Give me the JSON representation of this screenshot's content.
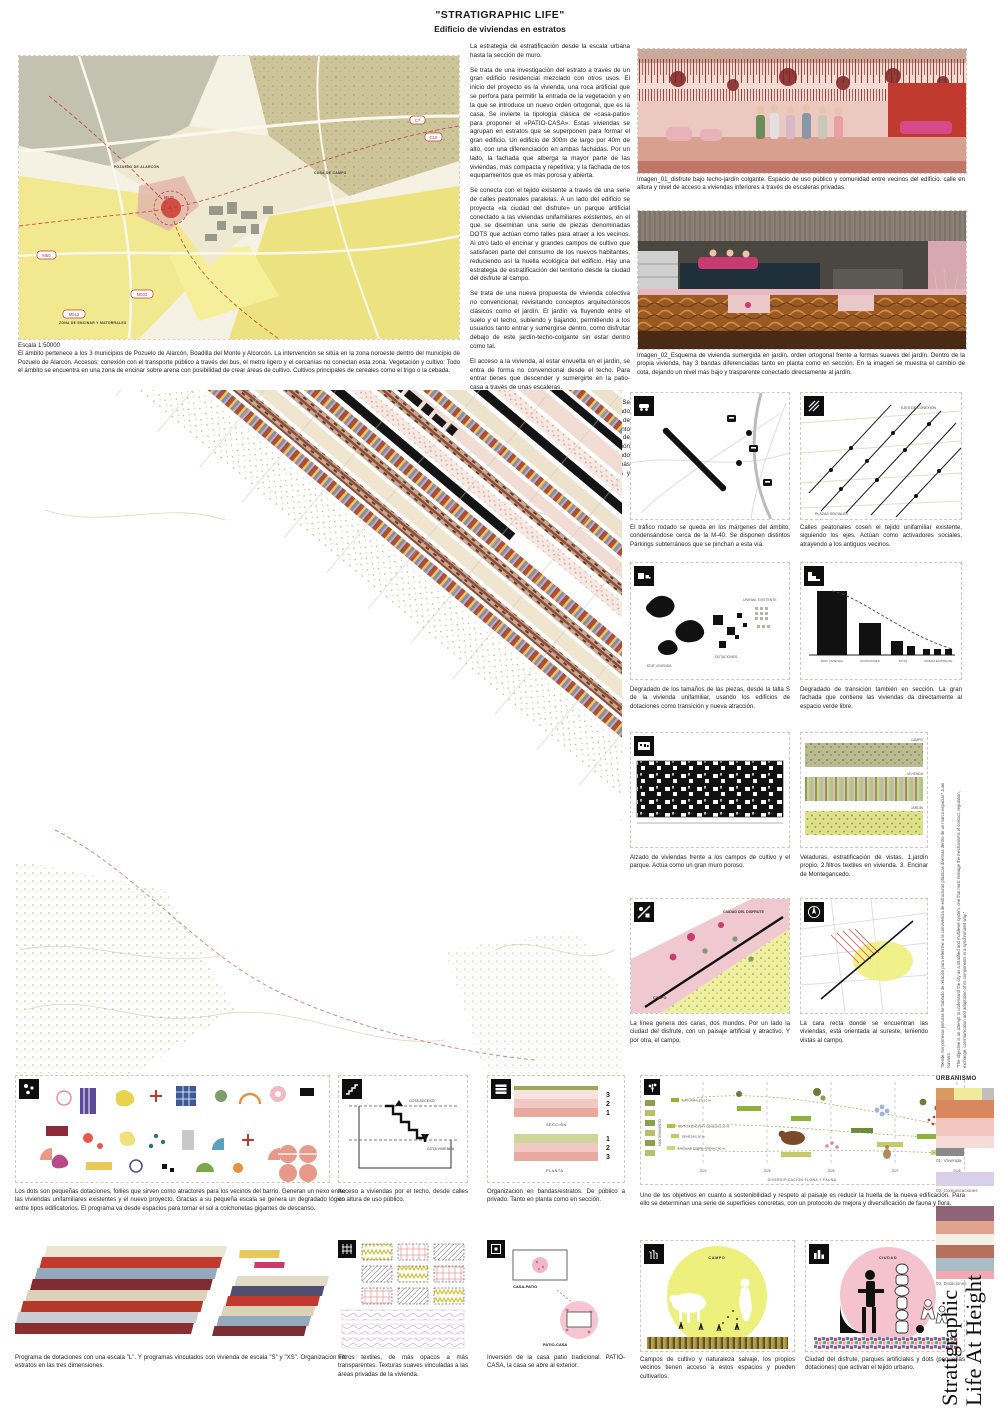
{
  "header": {
    "title": "\"STRATIGRAPHIC LIFE\"",
    "subtitle": "Edificio de viviendas en estratos"
  },
  "intro": {
    "paragraphs": [
      "La estrategia de estratificación desde la escala urbana hasta la sección de muro.",
      "Se trata de una investigación del estrato a través de un gran edificio residencial mezclado con otros usos. El inicio del proyecto es la vivienda, una roca artificial que se perfora para permitir la entrada de la vegetación y en la que se introduce un nuevo orden ortogonal, que es la casa. Se invierte la tipología clásica de «casa-patio» para proponer el «PATIO-CASA». Estas viviendas se agrupan en estratos que se superponen para formar el gran edificio. Un edificio de 300m de largo por 40m de alto, con una diferenciación en ambas fachadas. Por un lado, la fachada que alberga la mayor parte de las viviendas, más compacta y repetitiva; y la fachada de los equipamientos que es más porosa y abierta.",
      "Se conecta con el tejido existente a través de una serie de calles peatonales paralelas. A un lado del edificio se proyecta «la ciudad del disfrute» un parque artificial conectado a las viviendas unifamiliares existentes, en el que se diseminan una serie de piezas denominadas DOTS que actúan como talles para atraer a los vecinos. Al otro lado el encinar y grandes campos de cultivo que satisfacen parte del consumo de los nuevos habitantes, reduciendo así la huella ecológica del edificio. Hay una estrategia de estratificación del territorio desde la ciudad del disfrute al campo.",
      "Se trata de una nueva propuesta de vivienda colectiva no convencional, revisitando conceptos arquitectónicos clásicos como el jardín. El jardín va fluyendo entre el suelo y el techo, subiendo y bajando, permitiendo a los usuarios tanto entrar y sumergirse dentro, como disfrutar debajo de este jardín-techo-colgante sin estar dentro como tal.",
      "El acceso a la vivienda, al estar envuelta en el jardín, se entra de forma no convencional desde el techo. Para entrar tienes que descender y sumergirte en la patio-casa a través de unas escaleras.",
      "La vivienda se organiza en tres bandas, 3 estratos. Se disponen creando una degradación entre la más privado como es el dormitorio y el aseo, hasta una zona de disfrute y reunión más pública. Como elemento diferenciador entre capa y capa aparecen una serie de veladuras o filtros creando de nuevo una estratificación esta vez de vistas dentro de la propia vivienda. Siendo más opacos y de textura suave en la banda de más privacidad, para pasar a texturas más duras, frías y transparentes en la zona pública."
    ]
  },
  "site_map": {
    "scale": "Escala 1:50000",
    "caption": "El ámbito pertenece a los 3 municipios de Pozuelo de Alarcón, Boadilla del Monte y Alcorcón. La intervención se sitúa en la zona noroeste dentro del municipio de Pozuelo de Alarcón. Accesos: conexión con el transporte público a través del bus, el metro ligero y el cercanías no conectan esta zona. Vegetación y cultivo: Todo el ámbito se encuentra en una zona de encinar sobre arena con posibilidad de crear áreas de cultivo. Cultivos principales de cereales como el trigo o la cebada.",
    "labels": {
      "c7": "C7",
      "c10": "C10",
      "bus": "BUS",
      "m50": "M50",
      "m503": "M503",
      "m513": "M513",
      "casa_de_campo": "CASA DE CAMPO",
      "pozuelo": "POZUELO DE ALARCÓN",
      "encinar": "ZONA DE ENCINAR Y MATORRALES"
    }
  },
  "renders": {
    "img1_caption": "Imagen_01_disfrute bajo techo-jardín colgante. Espacio de uso público y comunidad entre vecinos del edificio. calle en altura y nivel de acceso a viviendas inferiores a través de escaleras privadas.",
    "img2_caption": "Imagen_02_Esquema de vivienda sumergida en jardín. orden ortogonal frente a formas suaves del jardín. Dentro de la propia vivienda, hay 3 bandas diferenciadas tanto en planta como en sección. En la imagen se muestra el cambio de cota, dejando un nivel más bajo y trasparente conectado directamente al jardín."
  },
  "grid": {
    "cards": [
      {
        "caption": "El tráfico rodado se queda en los márgenes del ámbito, condensándose cerca de la M-40. Se disponen distintos Parkings subterráneos que se pinchan a esta vía."
      },
      {
        "caption": "Calles peatonales cosen el tejido unifamiliar existente, siguiendo los ejes. Actúan como activadores sociales, atrayendo a los antiguos vecinos.",
        "labels": {
          "ejes": "EJES DE CONEXIÓN",
          "plazas": "PLAZAS SOCIALES"
        }
      },
      {
        "caption": "Degradado de los tamaños de las piezas, desde la talla S de la vivienda unifamiliar, usando los edificios de dotaciones como transición y nueva atracción.",
        "labels": {
          "unifam": "UNIFAM. EXISTENTE",
          "dotaciones": "DOTACIONES",
          "vivienda": "EDIF VIVIENDA"
        }
      },
      {
        "caption": "Degradado de transición también en sección. La gran fachada que contiene las viviendas da directamente al espacio verde libre.",
        "labels": {
          "vivienda": "EDIF VIVIENDA",
          "dotaciones": "DOTACIONES",
          "dots": "DOTS",
          "unifam": "UNIFAM EXISTENTE"
        }
      },
      {
        "caption": "Alzado de viviendas frente a los campos de cultivo y el parque. Actúa como un gran muro poroso."
      },
      {
        "caption": "Veladuras, estratificación de vistas. 1.jardín propio. 2.filtros textiles en vivienda. 3. Encinar de Montegancedo.",
        "labels": {
          "campo": "CAMPO",
          "vivienda": "VIVIENDA",
          "jardin": "JARDÍN"
        }
      },
      {
        "caption": "La línea genera dos caras, dos mundos. Por un lado la ciudad del disfrute, con un paisaje artificial y atractivo. Y por otra, el campo.",
        "labels": {
          "ciudad": "CIUDAD DEL DISFRUTE",
          "campo": "CAMPO"
        }
      },
      {
        "caption": "La cara recta donde se encuentran las viviendas, está orientada al sureste, teniendo vistas al campo."
      }
    ]
  },
  "bottom": {
    "dots_caption": "Los dots son pequeñas dotaciones, follies que sirven como atractores para los vecinos del barrio. Generan un nexo entre las viviendas unifamiliares existentes y el nuevo proyecto. Gracias a su pequeña escala se genera un degradado lógico entre tipos edificatorios. El programa va desde espacios para tomar el sol a colchonetas gigantes de descanso.",
    "acceso_caption": "Acceso a viviendas por el techo, desde calles en altura de uso público.",
    "acceso_labels": {
      "upper": "COTA ACCESO",
      "lower": "COTA VIVIENDA"
    },
    "bandas_caption": "Organización en bandas/estratos. De público a privado. Tanto en planta como en sección.",
    "bandas_labels": {
      "seccion": "SECCIÓN",
      "planta": "PLANTA",
      "sec_numbers": [
        "3",
        "2",
        "1"
      ],
      "plan_numbers": [
        "1",
        "2",
        "3"
      ]
    },
    "huella_caption": "Uno de los objetivos en cuanto a sostenibilidad y respeto al paisaje es reducir la huella de la nueva edificación. Para ello se determinan una serie de superficies concretas, con un protocolo de mejora y diversificación de fauna y flora.",
    "programa_caption": "Programa de dotaciones con una escala \"L\". Y programas vinculados con vivienda de escala \"S\" y \"XS\". Organización en estratos en las tres dimensiones.",
    "filtros_caption": "Filtros textiles, de más opacos a más transparentes. Texturas suaves vinculadas a las áreas privadas de la vivienda.",
    "inversion_caption": "Inversión de la casa patio tradicional. PATIO-CASA, la casa se abre al exterior.",
    "inversion_labels": {
      "a": "CASA-PATIO",
      "b": "PATIO-CASA"
    },
    "campos_caption": "Campos de cultivo y naturaleza salvaje, los propios vecinos tienen acceso a estos espacios y pueden cultivarlos.",
    "ciudad_caption": "Ciudad del disfrute, parques artificiales y dots (pequeñas dotaciones) que activan el tejido urbano.",
    "circle_labels": {
      "campo": "CAMPO",
      "ciudad": "CIUDAD"
    }
  },
  "timeline": {
    "type": "timeline",
    "ylabel": "MANTENIMIENTO",
    "xlabel": "DIVERSIFICACIÓN FLORA Y FAUNA",
    "years": [
      "2024",
      "2025",
      "2026",
      "2027",
      "2028"
    ],
    "series": [
      "MATORRALES 10 %",
      "MIXTO A ENCINA Y DEHESAS 30 %",
      "DEHESAS 20 %",
      "ENCINAR SOBRE ARENAS 80 %"
    ]
  },
  "sidebar": {
    "section_label": "URBANISMO",
    "quote_1": "“Desde mis primeras pinturas he hablado de relación para referirme a la convivencia de estructuras plásticas diversas dentro de un marco espacial.” Juan Navarro",
    "quote_2": "“The objective is an attempt to understand the city as a stratified and multilevel system, one that must manage the mechanisms of contact, regulation, exchange, communication and adaptation of its components in a synchronized way.”",
    "legend": [
      {
        "label": "01. Vivienda"
      },
      {
        "label": "02. Comunicaciones"
      },
      {
        "label": "03. Dotaciones"
      }
    ],
    "title_line_1": "Stratigraphic",
    "title_line_2": "Life At Height"
  }
}
